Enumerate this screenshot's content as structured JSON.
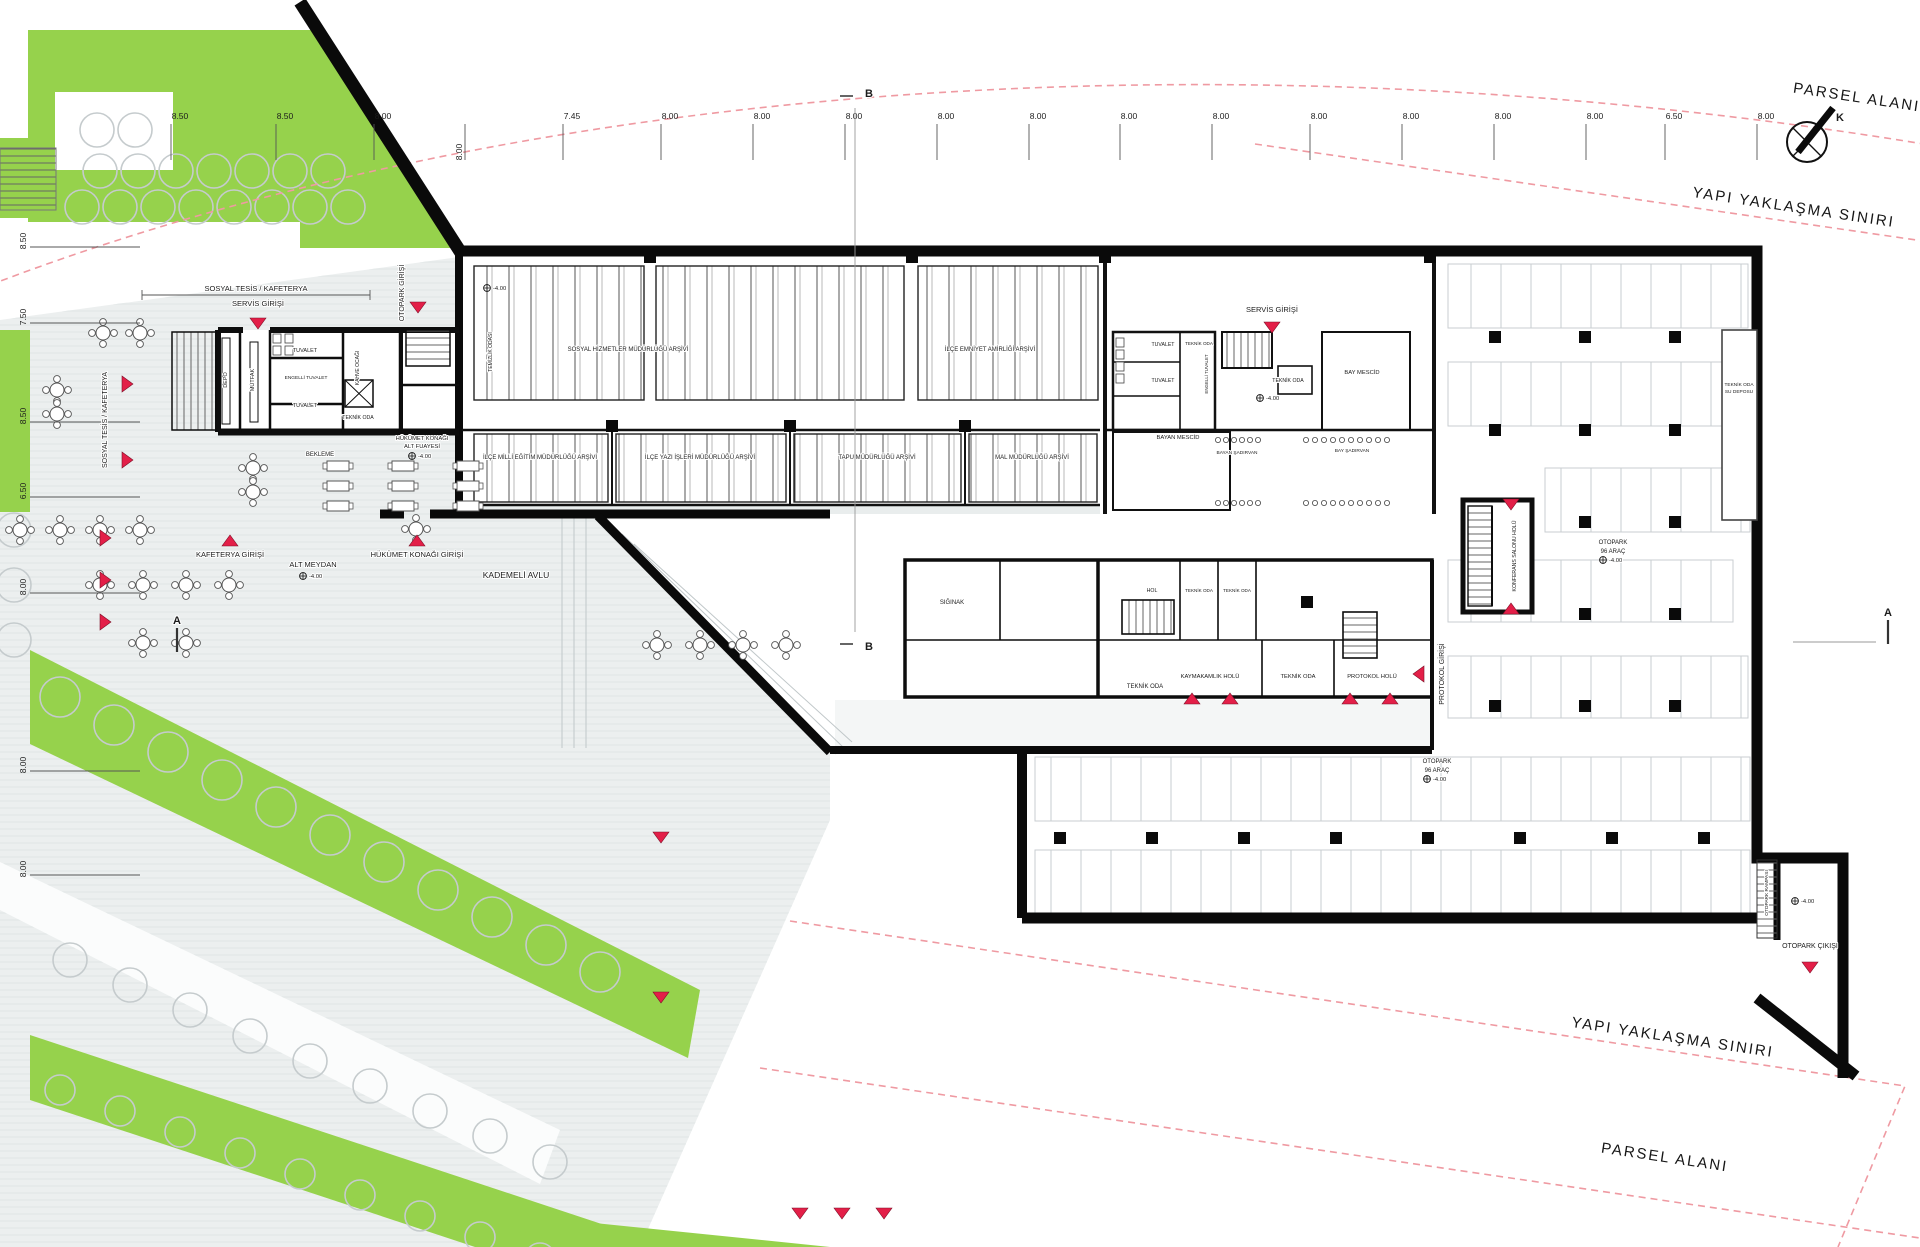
{
  "boundaries": {
    "parsel_top": "PARSEL ALANI",
    "yapi_top": "YAPI YAKLAŞMA SINIRI",
    "yapi_bottom": "YAPI YAKLAŞMA SINIRI",
    "parsel_bottom": "PARSEL ALANI"
  },
  "north_label": "K",
  "sections": {
    "a": "A",
    "b": "B"
  },
  "elevation": "-4.00",
  "dims": {
    "top": [
      "8.50",
      "8.50",
      "8.00",
      "8.00",
      "7.45",
      "8.00",
      "8.00",
      "8.00",
      "8.00",
      "8.00",
      "8.00",
      "8.00",
      "8.00",
      "8.00",
      "8.00",
      "8.00",
      "6.50",
      "8.00"
    ],
    "left": [
      "8.50",
      "7.50",
      "8.50",
      "6.50",
      "8.00",
      "8.00",
      "8.00"
    ]
  },
  "entrances": {
    "servis_left": "SERVİS GİRİŞİ",
    "otopark": "OTOPARK GİRİŞİ",
    "servis_right": "SERVİS GİRİŞİ",
    "kafeterya": "KAFETERYA GİRİŞİ",
    "hukumet": "HÜKÜMET KONAĞI GİRİŞİ",
    "protokol": "PROTOKOL GİRİŞİ",
    "otopark_cikis": "OTOPARK ÇIKIŞI"
  },
  "areas": {
    "sosyal_tesis": "SOSYAL TESİS / KAFETERYA",
    "sosyal_tesis_side": "SOSYAL TESİS / KAFETERYA",
    "alt_meydan": "ALT MEYDAN",
    "kademeli_avlu": "KADEMELİ AVLU",
    "fuaye1": "HÜKÜMET KONAĞI",
    "fuaye2": "ALT FUAYESİ",
    "bekleme": "BEKLEME",
    "otopark1": "OTOPARK",
    "otopark2": "96 ARAÇ",
    "konferans": "KONFERANS SALONU HOLÜ",
    "rampa": "OTOPARK RAMPASI"
  },
  "rooms": {
    "depo": "DEPO",
    "mutfak": "MUTFAK",
    "tuvalet": "TUVALET",
    "engelli": "ENGELLİ TUVALET",
    "kahve": "KAHVE OCAĞI",
    "teknik": "TEKNİK ODA",
    "temizlik": "TEMİZLİK ODASI",
    "arsiv1": "SOSYAL HİZMETLER MÜDÜRLÜĞÜ ARŞİVİ",
    "arsiv2": "İLÇE EMNİYET AMİRLİĞİ ARŞİVİ",
    "arsiv3": "İLÇE MİLLİ EĞİTİM MÜDÜRLÜĞÜ ARŞİVİ",
    "arsiv4": "İLÇE YAZI İŞLERİ MÜDÜRLÜĞÜ ARŞİVİ",
    "arsiv5": "TAPU MÜDÜRLÜĞÜ ARŞİVİ",
    "arsiv6": "MAL MÜDÜRLÜĞÜ ARŞİVİ",
    "bay_mescid": "BAY MESCİD",
    "bayan_mescid": "BAYAN MESCİD",
    "bay_sadirvan": "BAY ŞADIRVAN",
    "bayan_sadirvan": "BAYAN ŞADIRVAN",
    "hol": "HOL",
    "siginak": "SIĞINAK",
    "kaymakamlik": "KAYMAKAMLIK HOLÜ",
    "protokol_holu": "PROTOKOL HOLÜ",
    "su1": "TEKNİK ODA",
    "su2": "SU DEPOSU"
  },
  "colors": {
    "green": "#96d24c",
    "plaza": "#ecefef",
    "red_marker": "#e2router",
    "marker_red": "#e31f48",
    "boundary_pink": "#ef9aa2",
    "wall_black": "#0a0a0a"
  }
}
